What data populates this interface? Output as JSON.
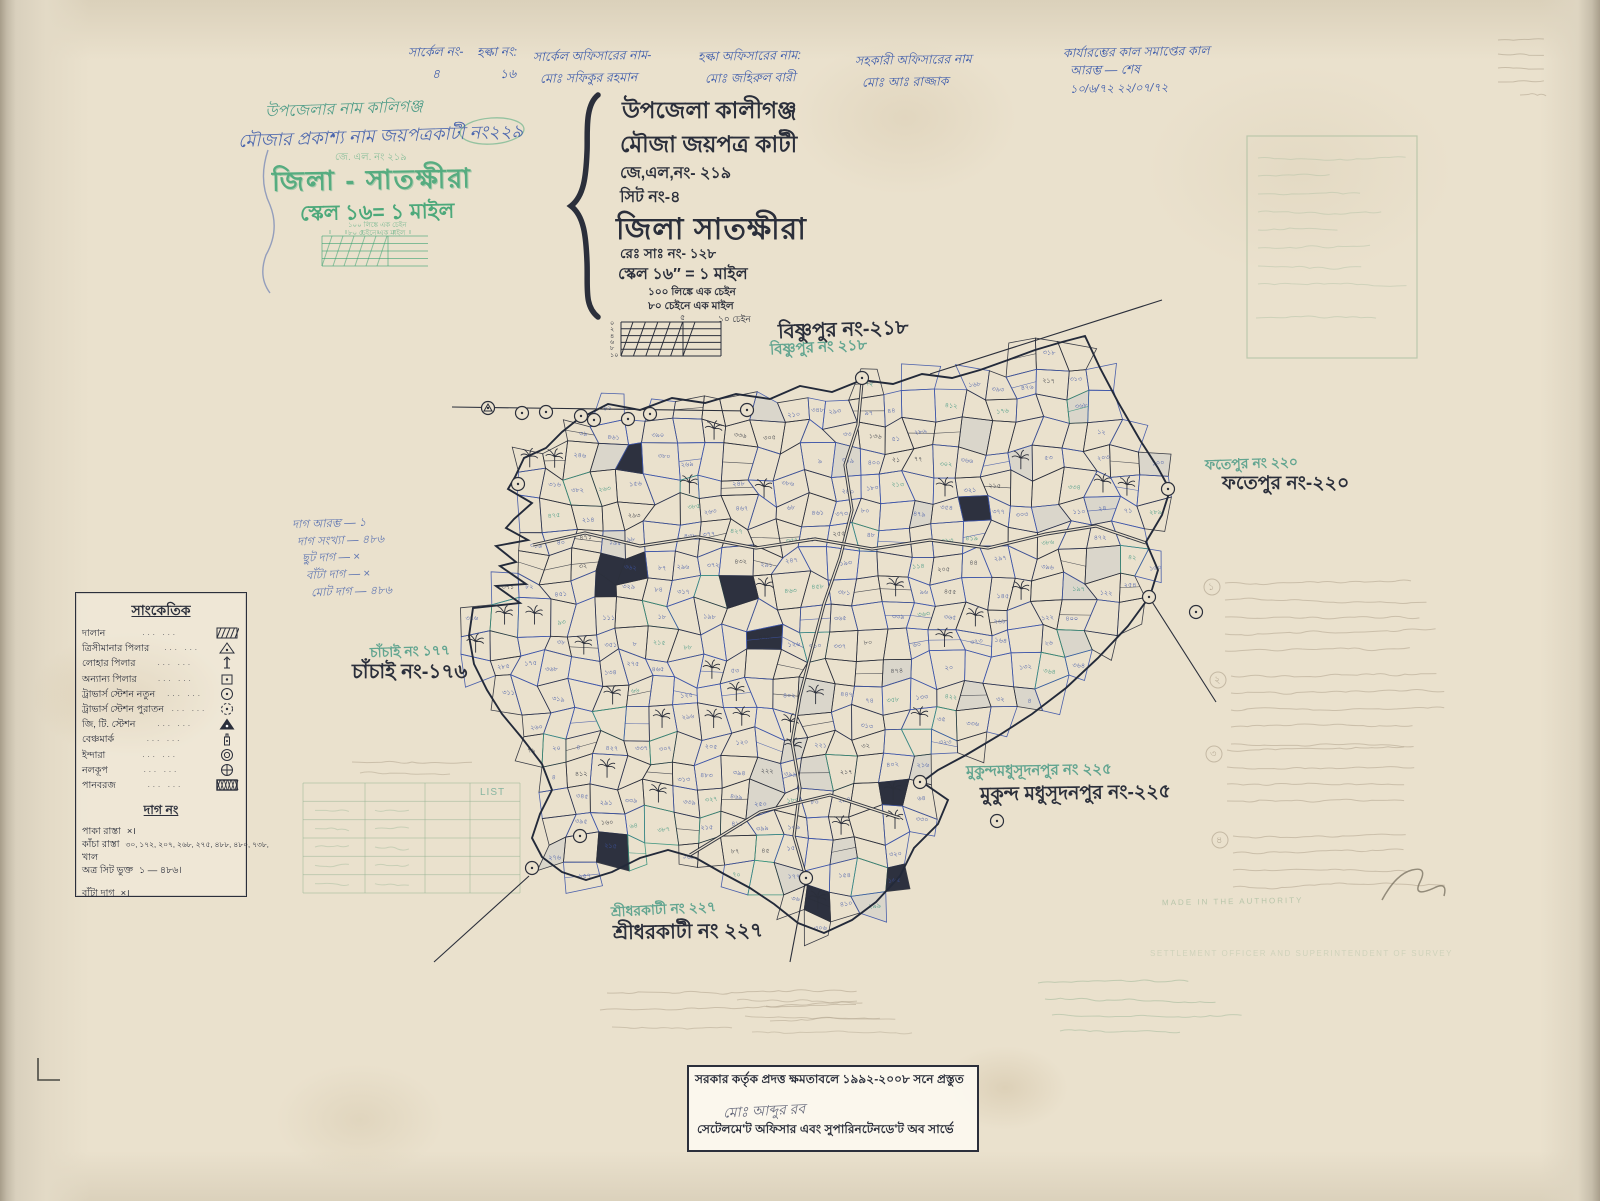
{
  "colors": {
    "paper": "#eae1cd",
    "ink": "#2b2f3b",
    "blue": "#3e5cab",
    "teal": "#35917c",
    "stampgreen": "#3da373",
    "faintgreen": "#97b494",
    "pencil": "#ab9e88",
    "mapblue": "#3d55a8"
  },
  "header_row": {
    "columns": [
      {
        "label": "সার্কেল নং-",
        "value": "৪"
      },
      {
        "label": "হল্কা নং:",
        "value": "১৬"
      },
      {
        "label": "সার্কেল অফিসারের নাম-",
        "value": "মোঃ সফিকুর রহমান"
      },
      {
        "label": "হল্কা অফিসারের নাম:",
        "value": "মোঃ জহিরুল বারী"
      },
      {
        "label": "সহকারী অফিসারের নাম",
        "value": "মোঃ আঃ রাজ্জাক"
      },
      {
        "label": "কার্যারম্ভের কাল  সমাপ্তের কাল",
        "value": "আরম্ভ — শেষ",
        "value2": "১০/৬/৭২    ২২/০৭/৭২"
      }
    ]
  },
  "handwritten_block": {
    "line1": "উপজেলার নাম কালিগঞ্জ",
    "line2": "মৌজার প্রকাশ্য নাম জয়পত্রকাটী নং২২৯",
    "jl_faint": "জে. এল. নং ২১৯",
    "district_stamp": "জিলা - সাতক্ষীরা",
    "scale_stamp": "স্কেল ১৬= ১ মাইল",
    "chain1": "১০০ লিঙ্কে এক চেইন",
    "chain2": "৮০ চেইনে এক মাইল"
  },
  "title_block": {
    "upazila": "উপজেলা কালীগঞ্জ",
    "mouza": "মৌজা জয়পত্র কাটী",
    "jl_no": "জে,এল,নং- ২১৯",
    "sheet_no": "সিট নং-৪",
    "district": "জিলা সাতক্ষীরা",
    "rs_no": "রেঃ সাঃ নং- ১২৮",
    "scale": "স্কেল ১৬″ = ১ মাইল",
    "chain_note1": "১০০ লিঙ্কে এক চেইন",
    "chain_note2": "৮০ চেইনে এক মাইল"
  },
  "scale_diagram": {
    "left_ticks": [
      "০",
      "২",
      "৪",
      "৬",
      "৮",
      "১০"
    ],
    "mid": "৫",
    "right": "১০ চেইন"
  },
  "plot_summary": {
    "lines": [
      "দাগ আরম্ভ — ১",
      "দাগ সংখ্যা — ৪৮৬",
      "ছুট দাগ — ×",
      "বাঁটা দাগ — ×",
      "মোট দাগ — ৪৮৬"
    ]
  },
  "legend": {
    "title": "সাংকেতিক",
    "items": [
      {
        "label": "দালান",
        "symbol": "hatch"
      },
      {
        "label": "ত্রিসীমানার পিলার",
        "symbol": "tri_dot"
      },
      {
        "label": "লোহার পিলার",
        "symbol": "pin"
      },
      {
        "label": "অন্যান্য পিলার",
        "symbol": "sq_dot"
      },
      {
        "label": "ট্রাভার্স স্টেশন নতুন",
        "symbol": "circ_dot"
      },
      {
        "label": "ট্রাভার্স স্টেশন পুরাতন",
        "symbol": "circ_dashed"
      },
      {
        "label": "জি, টি. স্টেশন",
        "symbol": "tri_filled"
      },
      {
        "label": "বেঞ্চমার্ক",
        "symbol": "bottle"
      },
      {
        "label": "ইন্দারা",
        "symbol": "double_circ"
      },
      {
        "label": "নলকূপ",
        "symbol": "circ_cross"
      },
      {
        "label": "পানবরজ",
        "symbol": "crosshatch"
      }
    ],
    "dag_title": "দাগ নং",
    "dag_rows": [
      {
        "label": "পাকা রাস্তা",
        "value": "×।"
      },
      {
        "label": "কাঁচা রাস্তা",
        "value": "৩০, ১৭২, ২০৭, ২৬৮, ২৭৫, ৪৮৮, ৪৮০, ৭৩৮,"
      },
      {
        "label": "খাল",
        "value": ""
      },
      {
        "label": "অত্র সিট ভুক্ত",
        "value": "১ — ৪৮৬।"
      },
      {
        "label": "বাঁটা দাগ",
        "value": "×।"
      }
    ]
  },
  "neighbors": [
    {
      "name_stamp": "বিষ্ণুপুর নং ২১৮",
      "name_ink": "বিষ্ণুপুর নং-২১৮"
    },
    {
      "name_stamp": "ফতেপুর নং ২২০",
      "name_ink": "ফতেপুর নং-২২০"
    },
    {
      "name_stamp": "চাঁচাই নং ১৭৭",
      "name_ink": "চাঁচাই নং-১৭৬"
    },
    {
      "name_stamp": "মুকুন্দমধুসূদনপুর নং ২২৫",
      "name_ink": "মুকুন্দ মধুসূদনপুর নং-২২৫"
    },
    {
      "name_stamp": "শ্রীধরকাটী নং ২২৭",
      "name_ink": "শ্রীধরকাটী নং ২২৭"
    }
  ],
  "side_notes": {
    "markers": [
      "১",
      "২",
      "৩",
      "৪"
    ]
  },
  "list_table": {
    "header": "LIST"
  },
  "faint_english": {
    "line1": "MADE IN THE AUTHORITY",
    "line2": "SETTLEMENT OFFICER AND SUPERINTENDENT OF SURVEY"
  },
  "stamp": {
    "line1": "সরকার কর্তৃক প্রদত্ত ক্ষমতাবলে ১৯৯২-২০০৮ সনে প্রস্তুত",
    "signature": "মোঃ আব্দুর রব",
    "line2": "সেটেলমে'ট অফিসার এবং সুপারিনটেনডে'ট অব সার্ভে"
  },
  "map_meta": {
    "plot_number_range": "১ — ৪৮৬"
  }
}
